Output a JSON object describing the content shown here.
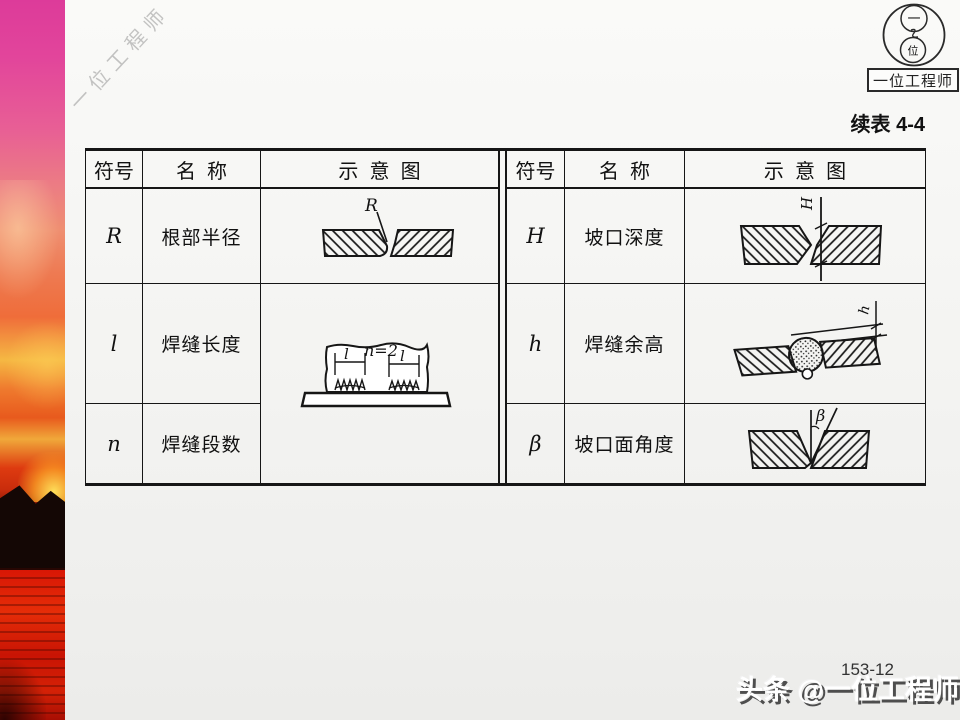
{
  "caption": "续表 4-4",
  "logo": {
    "name": "一位工程师",
    "top_char": "一",
    "bottom_char": "位"
  },
  "watermarks": {
    "corner": "一位工程师",
    "bottom": "头条 @一位工程师"
  },
  "footer": {
    "page_number": "153-12"
  },
  "table_left": {
    "headers": [
      "符号",
      "名  称",
      "示  意  图"
    ],
    "rows": [
      {
        "symbol": "R",
        "name": "根部半径"
      },
      {
        "symbol": "l",
        "name": "焊缝长度"
      },
      {
        "symbol": "n",
        "name": "焊缝段数"
      }
    ]
  },
  "table_right": {
    "headers": [
      "符号",
      "名  称",
      "示  意  图"
    ],
    "rows": [
      {
        "symbol": "H",
        "name": "坡口深度"
      },
      {
        "symbol": "h",
        "name": "焊缝余高"
      },
      {
        "symbol": "β",
        "name": "坡口面角度"
      }
    ]
  },
  "diagrams": {
    "root_radius_label": "R",
    "groove_depth_label": "H",
    "weld_length_label_left": "l",
    "segment_count_label": "n=2",
    "weld_length_label_right": "l",
    "reinforcement_label": "h",
    "groove_angle_label": "β"
  },
  "colors": {
    "line": "#161616",
    "sunset_pink": "#e2459b",
    "sunset_orange": "#ef6d3a",
    "sunset_red": "#d81605",
    "watermark_white": "#ffffff",
    "watermark_shadow": "#4e4e4e"
  }
}
